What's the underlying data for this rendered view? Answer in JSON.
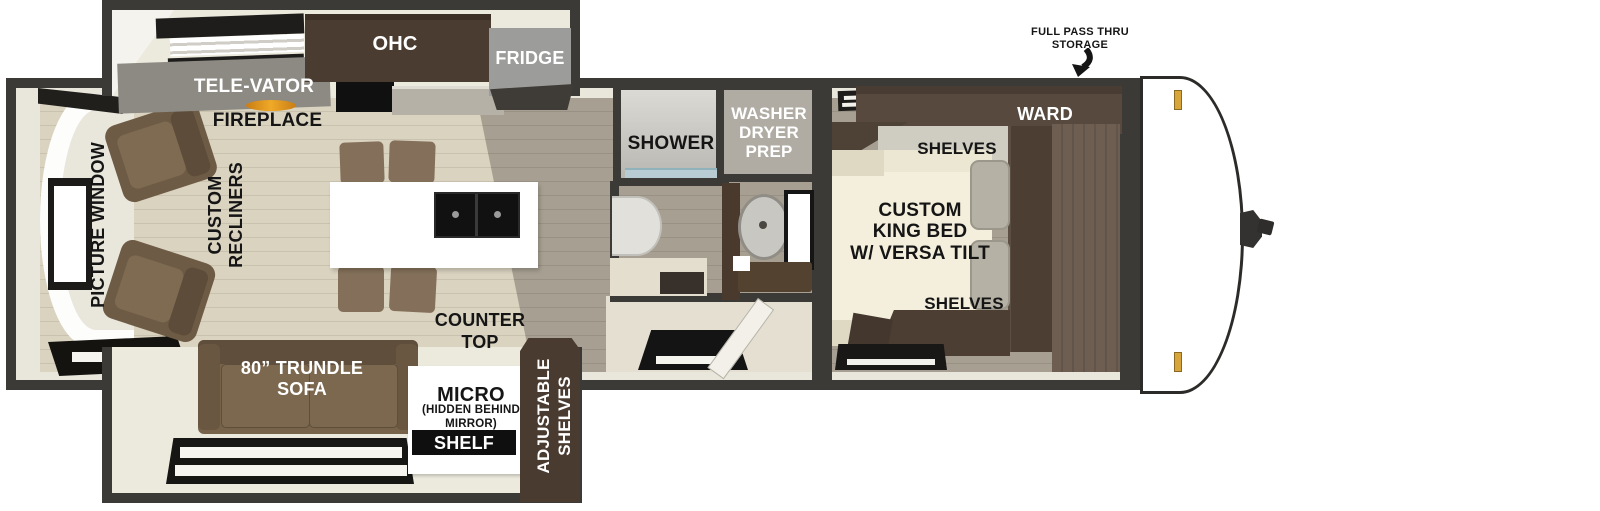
{
  "diagram": {
    "type": "rv-floorplan",
    "labels": {
      "kitchen_slide": {
        "televator": "TELE-VATOR",
        "ohc": "OHC",
        "fridge": "FRIDGE"
      },
      "living_area": {
        "fireplace": "FIREPLACE",
        "picture_window": "PICTURE WINDOW",
        "custom_recliners": "CUSTOM\nRECLINERS",
        "counter_top": "COUNTER\nTOP"
      },
      "sofa_slide": {
        "trundle_sofa": "80” TRUNDLE\nSOFA",
        "micro": "MICRO",
        "micro_note": "(HIDDEN BEHIND\nMIRROR)",
        "shelf": "SHELF",
        "adjustable_shelves": "ADJUSTABLE\nSHELVES"
      },
      "bathroom": {
        "shower": "SHOWER",
        "washer_dryer_prep": "WASHER\nDRYER\nPREP"
      },
      "bedroom": {
        "ward": "WARD",
        "shelves_top": "SHELVES",
        "king_bed": "CUSTOM\nKING BED\nW/ VERSA TILT",
        "shelves_bottom": "SHELVES"
      },
      "front": {
        "full_pass_thru_storage": "FULL PASS THRU\nSTORAGE"
      }
    },
    "colors": {
      "wall": "#3b3a37",
      "interior_wall_lining": "#e9e6db",
      "floor_light_plank": "#dad3c0",
      "floor_gray_plank": "#a7a092",
      "slide_floor": "#ece9dd",
      "sofa_brown": "#77634a",
      "cabinet_dark_wood": "#4a3c30",
      "ward_wood": "#57493e",
      "bed_cream": "#f2edda",
      "fridge_gray": "#9c9c9a",
      "flame_orange": "#e0941c",
      "clearance_light_orange": "#d8a43c",
      "label_black": "#151515",
      "label_white": "#ffffff"
    }
  }
}
